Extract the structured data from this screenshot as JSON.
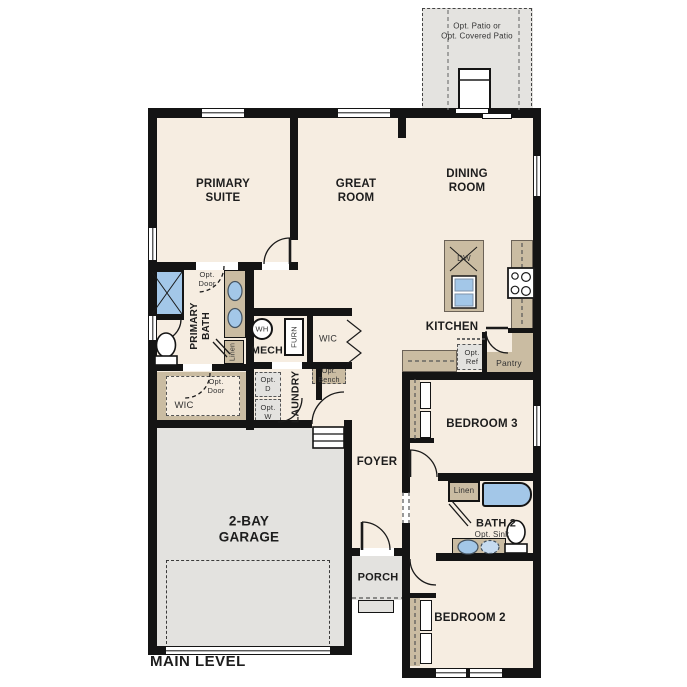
{
  "labels": {
    "patio": "Opt. Patio or\nOpt. Covered Patio",
    "primary_suite": "PRIMARY\nSUITE",
    "great_room": "GREAT\nROOM",
    "dining_room": "DINING\nROOM",
    "kitchen": "KITCHEN",
    "dw": "DW",
    "opt_ref": "Opt.\nRef",
    "pantry": "Pantry",
    "primary_bath": "PRIMARY\nBATH",
    "opt_door_bath": "Opt.\nDoor",
    "opt_door_wic": "Opt.\nDoor",
    "linen_primary": "Linen",
    "mech": "MECH",
    "wh": "WH",
    "furn": "FURN",
    "wic_hall": "WIC",
    "opt_bench": "Opt.\nBench",
    "laundry": "LAUNDRY",
    "opt_d": "Opt.\nD",
    "opt_w": "Opt.\nW",
    "wic_primary": "WIC",
    "garage": "2-BAY\nGARAGE",
    "foyer": "FOYER",
    "porch": "PORCH",
    "bedroom3": "BEDROOM 3",
    "linen_hall": "Linen",
    "bath2": "BATH 2",
    "opt_sink": "Opt. Sink",
    "bedroom2": "BEDROOM 2",
    "main_level": "MAIN LEVEL"
  },
  "colors": {
    "wall": "#141414",
    "floor": "#f6ede1",
    "garage_gray": "#e3e2df",
    "cabinet_tan": "#cabca2",
    "fixture_blue": "#a3c7e8",
    "patio_gray": "#e4e3e0"
  }
}
